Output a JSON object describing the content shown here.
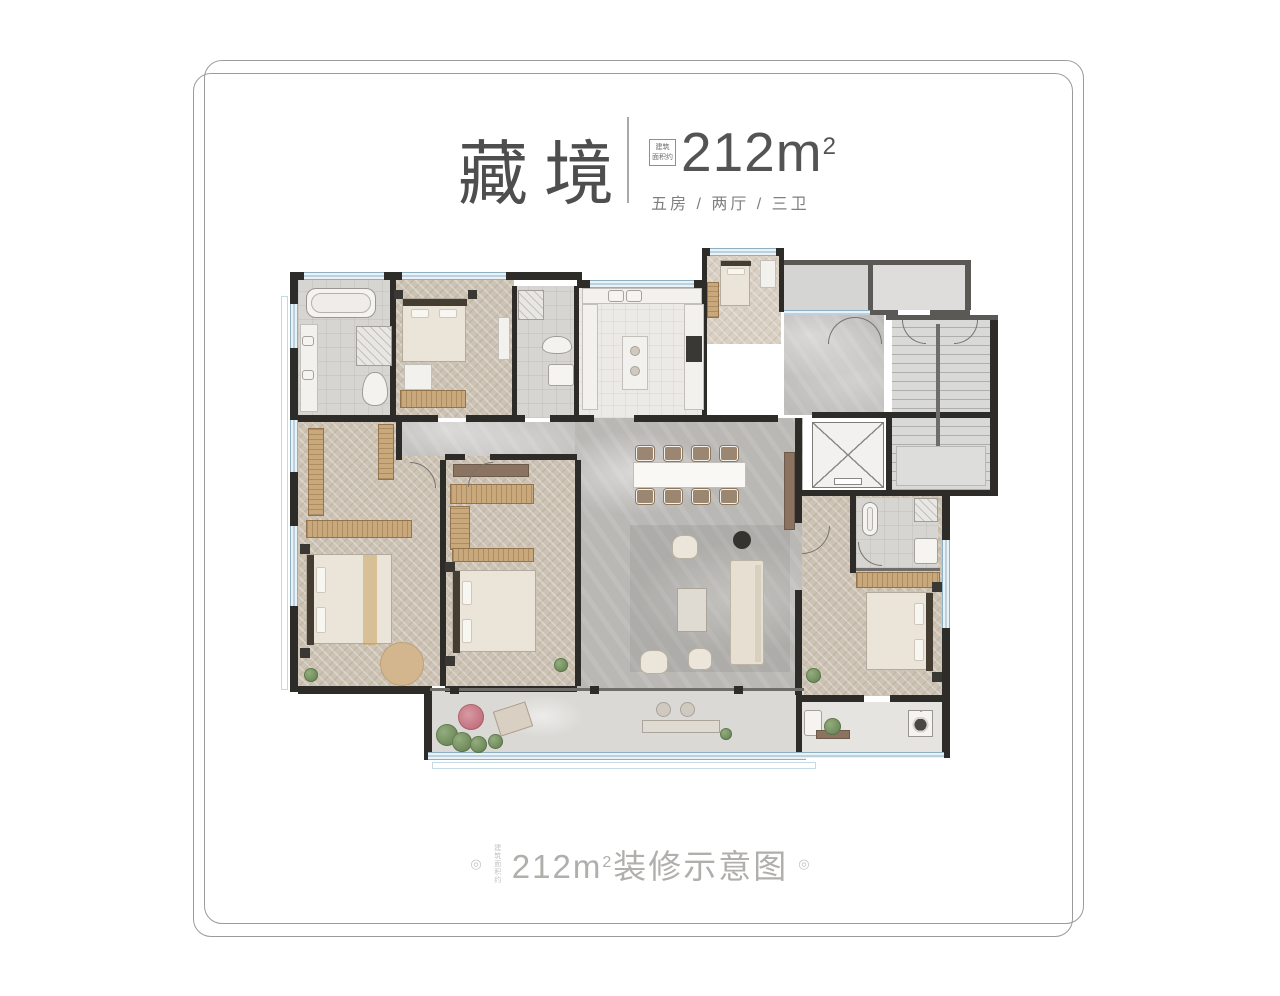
{
  "header": {
    "title": "藏境",
    "badge": {
      "line1": "建筑",
      "line2": "面积约"
    },
    "area": {
      "value": "212m",
      "sup": "2"
    },
    "spec": "五房 / 两厅 / 三卫"
  },
  "footer": {
    "deco_left": "◎",
    "vertical_note": "建筑面积约",
    "area": {
      "value": "212m",
      "sup": "2"
    },
    "suffix": "装修示意图",
    "deco_right": "◎"
  },
  "palette": {
    "wall": "#2e2c29",
    "wood": "#c9a87c",
    "marble": "#bab8b5",
    "herringbone": "#cdc3b5",
    "tile": "#d7d5d1",
    "window_blue": "#cfe2ee",
    "title_text": "#4e4e4e",
    "spec_text": "#7f7f7f",
    "footer_text": "#b1afac",
    "frame_line": "#9b9b9b"
  }
}
